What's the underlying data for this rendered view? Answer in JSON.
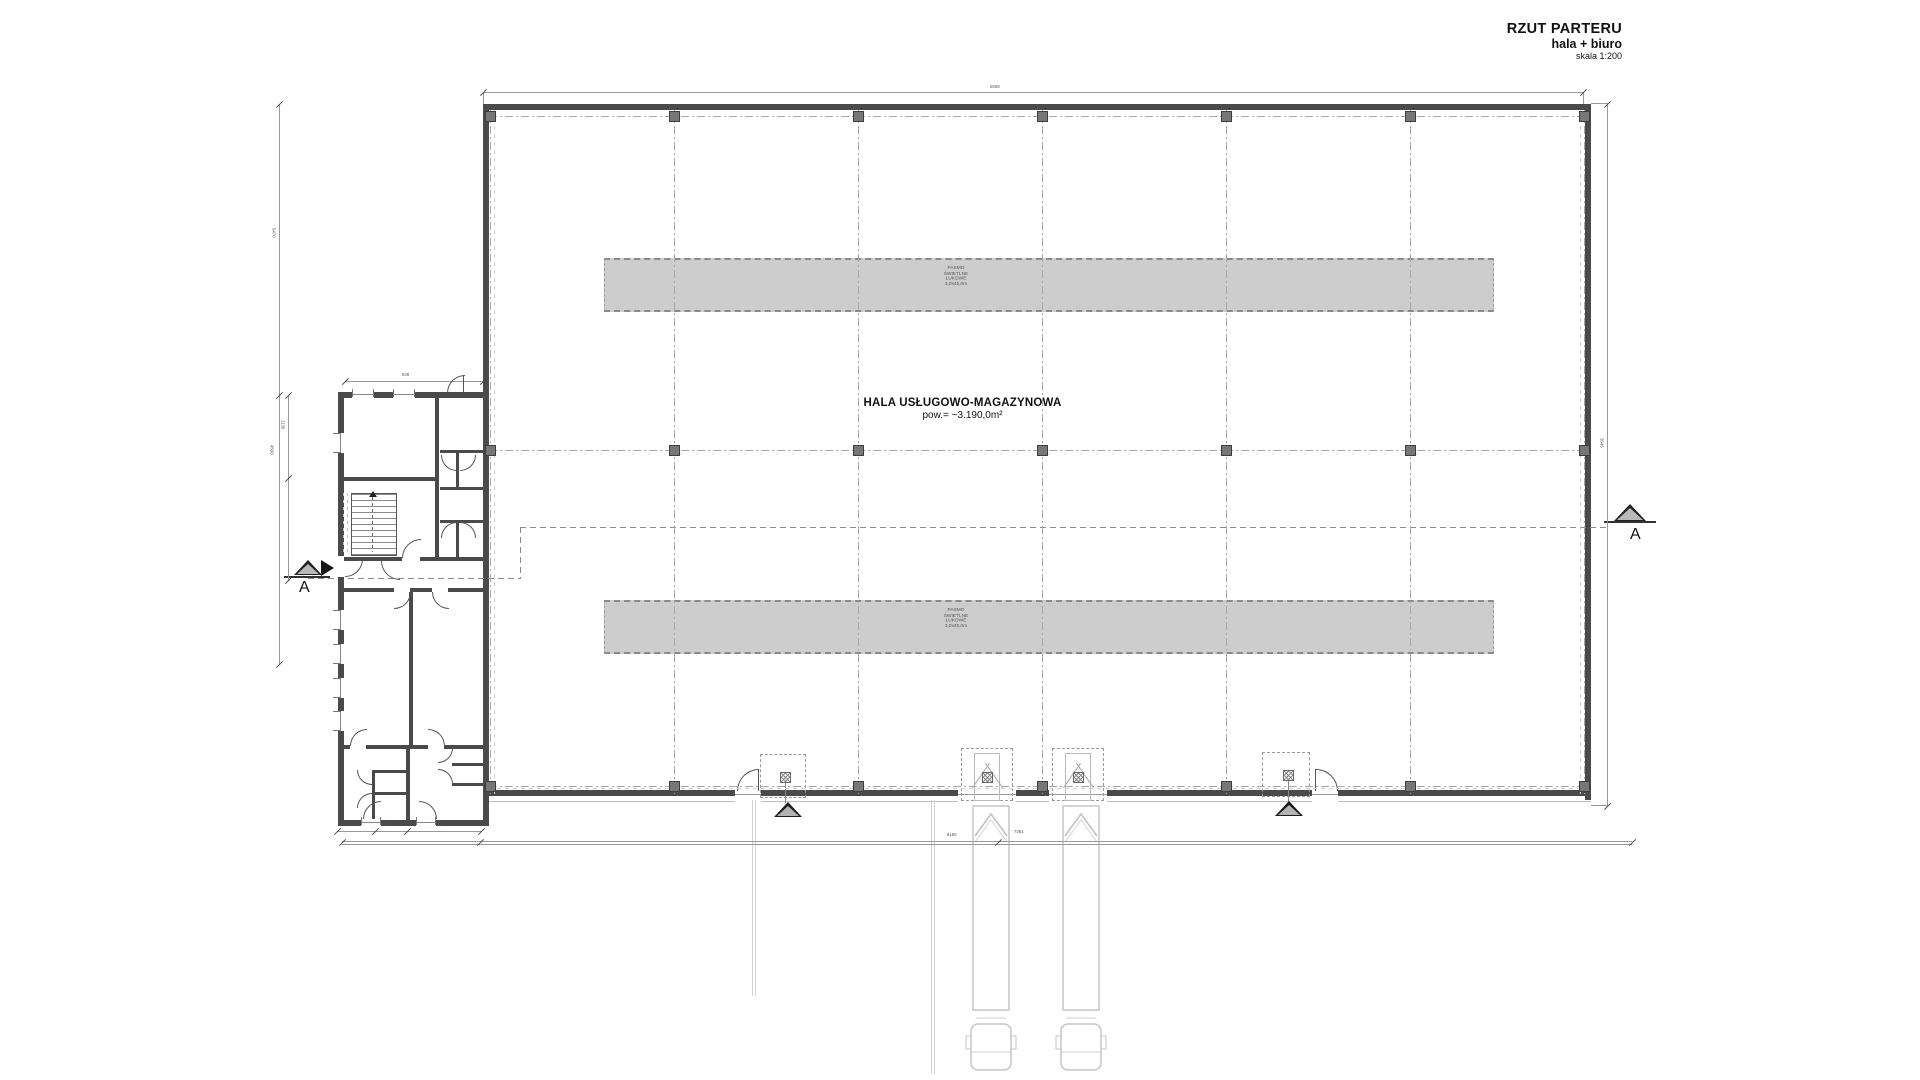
{
  "title_block": {
    "line1": "RZUT PARTERU",
    "line2": "hala + biuro",
    "line3": "skala 1:200"
  },
  "hall": {
    "name": "HALA USŁUGOWO-MAGAZYNOWA",
    "area": "pow.= ~3.190,0m²"
  },
  "skylight": {
    "line1": "PASMO",
    "line2": "ŚWIETLNE",
    "line3": "ŁUKOWE",
    "line4": "3,0x45,0m"
  },
  "section": {
    "left_label": "A",
    "right_label": "A"
  },
  "dimensions": {
    "top": "5598",
    "right": "3545",
    "left_outer_upper": "5470",
    "left_outer_lower": "4500",
    "left_inner": "1135",
    "office_top": "938",
    "office_bottom_left": "415",
    "office_bottom_mid": "104",
    "office_bottom_right": "415",
    "bottom_left": "8195",
    "bottom_right": "7381"
  },
  "colors": {
    "wall": "#4a4a4a",
    "grid": "#a8a8a8",
    "skylight_fill": "#cdcdcd",
    "marker_fill": "#b9b9b9",
    "accent_blue": "#2e3ec0"
  }
}
